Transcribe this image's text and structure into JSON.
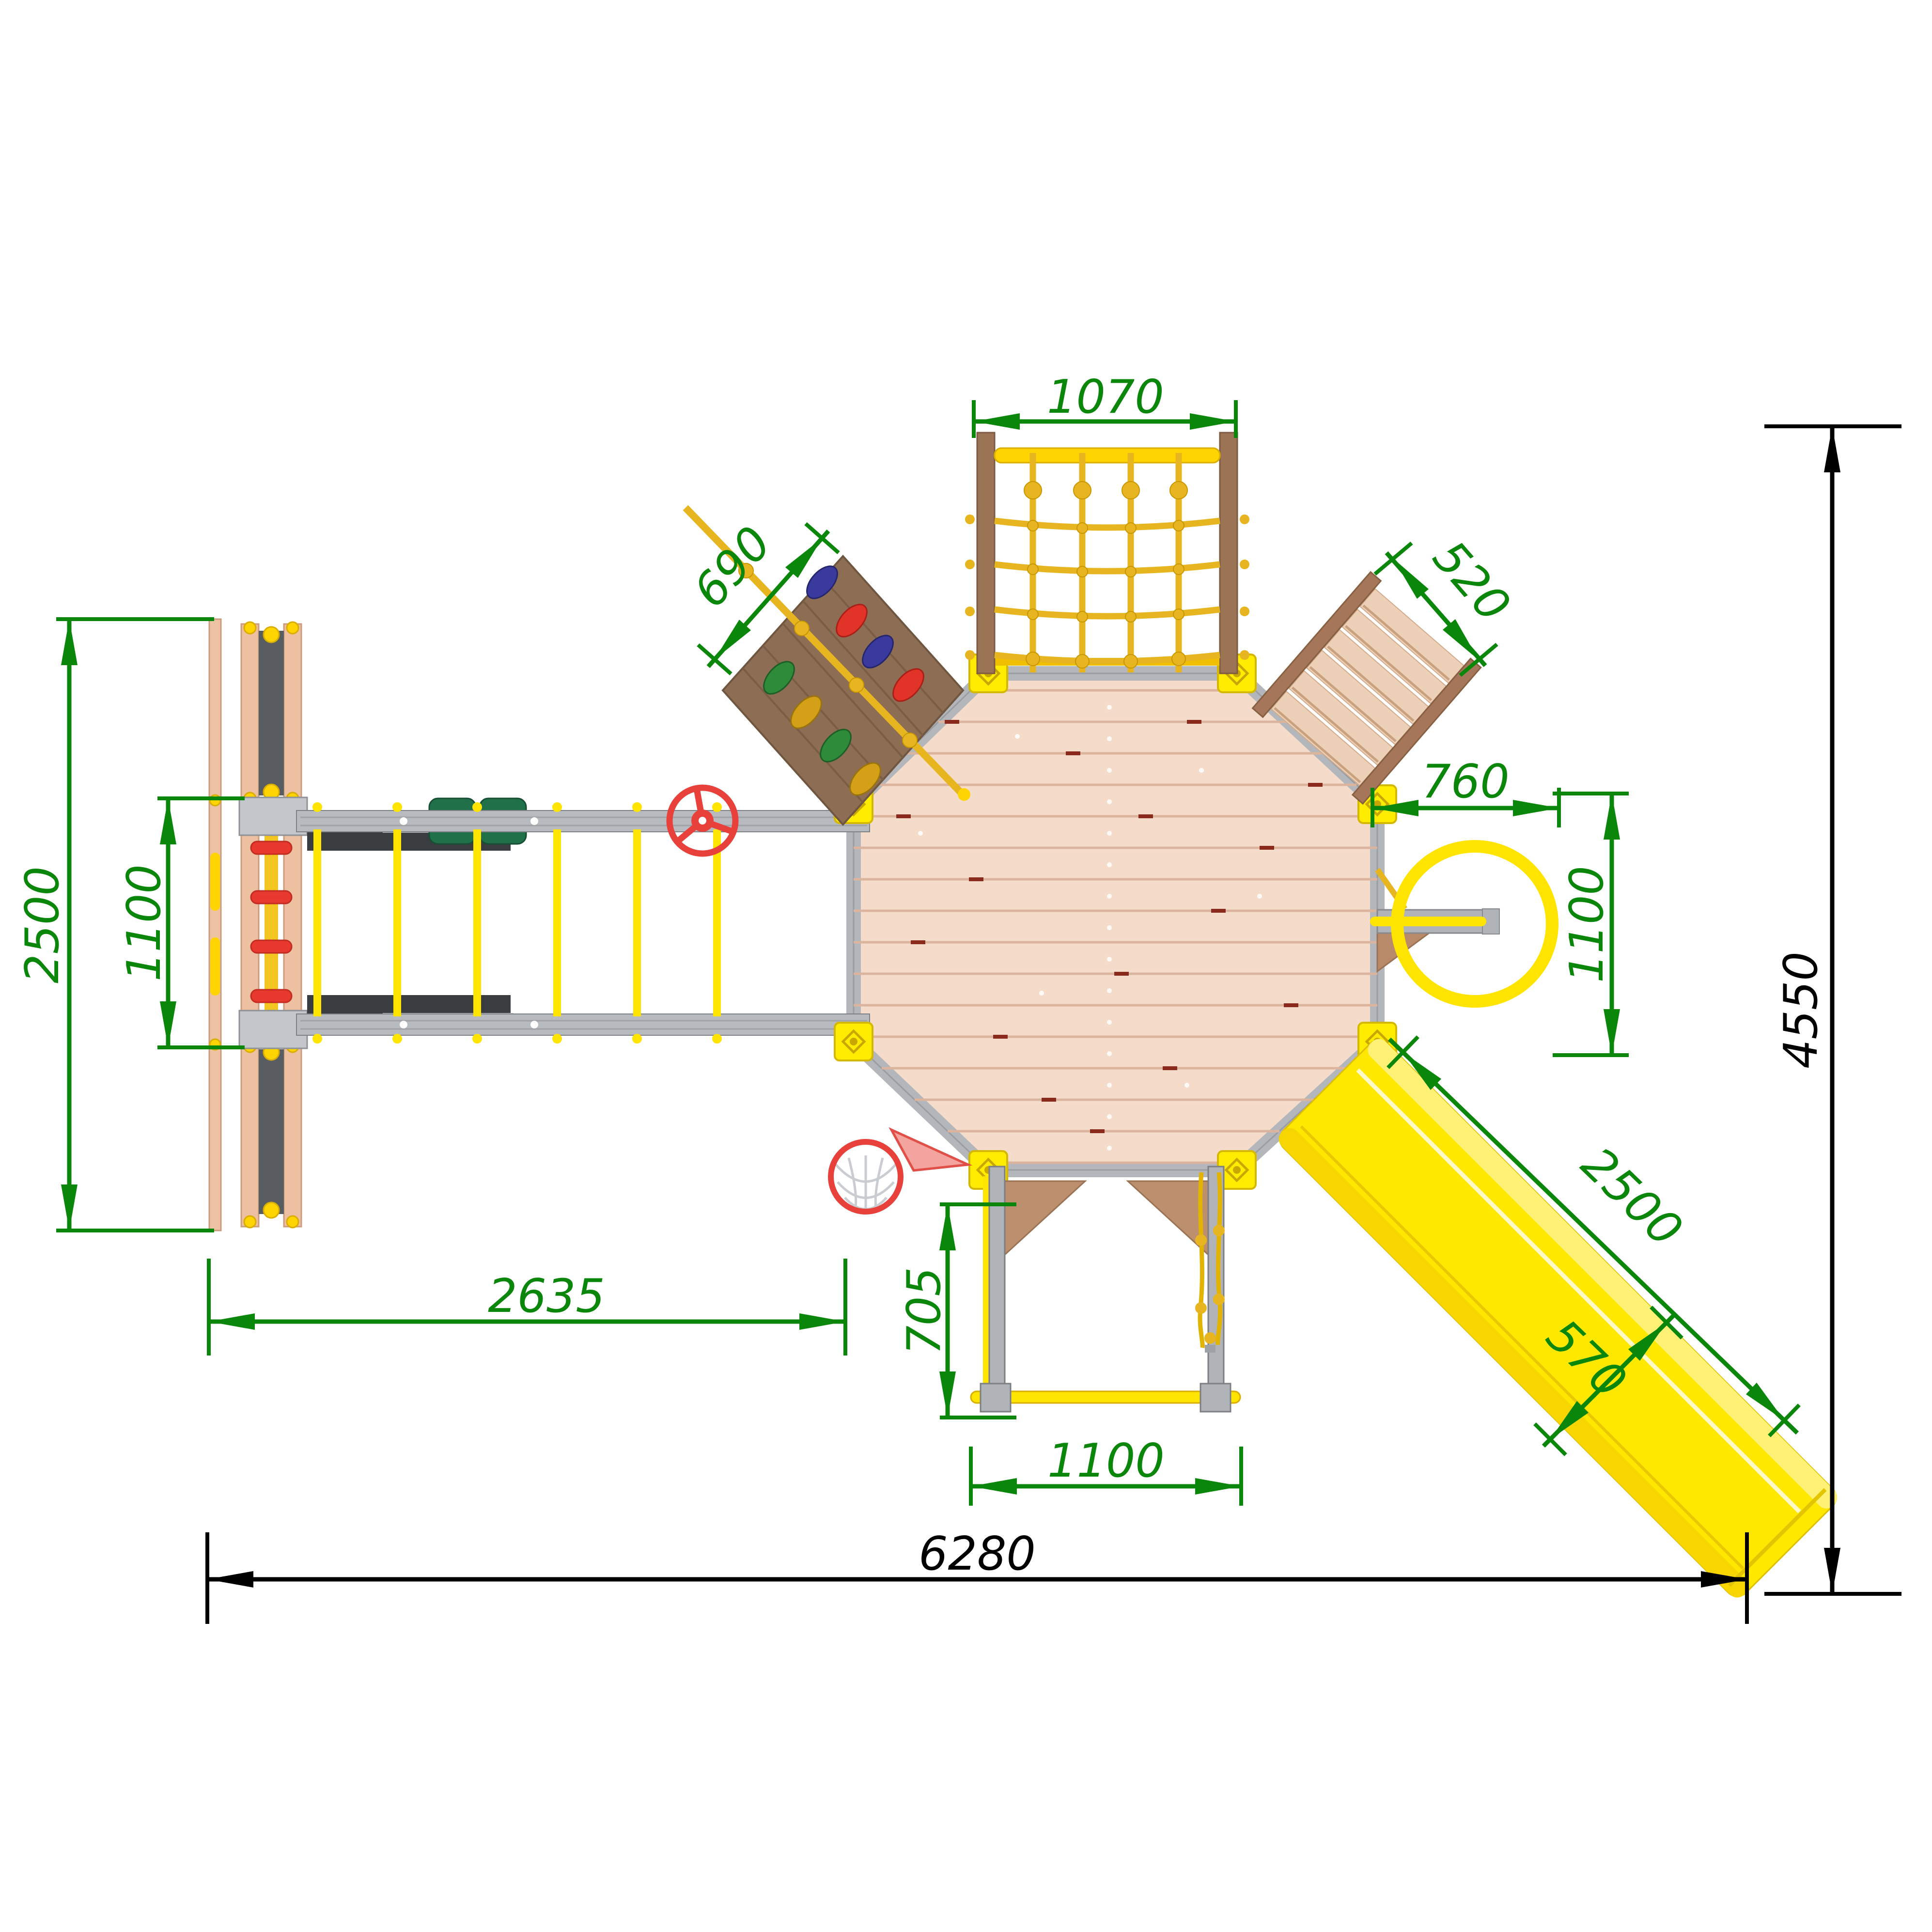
{
  "drawing": {
    "kind": "playground-set top view installation plan",
    "units": "mm",
    "background": "#ffffff"
  },
  "dims": {
    "net_width": "1070",
    "climb_wall_width": "690",
    "stairs_width": "520",
    "ring_offset": "760",
    "ring_clearance": "1100",
    "module_depth": "2500",
    "ladder_width": "1100",
    "bridge_length": "2635",
    "swing_depth": "705",
    "swing_width": "1100",
    "slide_length": "2500",
    "slide_width": "570",
    "overall_length": "6280",
    "overall_depth": "4550"
  },
  "components": {
    "platform": "octagonal-deck",
    "net": "climbing-net",
    "wall": "climbing-wall",
    "stairs": "access-stairs",
    "ring": "fireman-ring",
    "slide": "slide",
    "swing": "pull-up-bar-with-rope-ladder",
    "hoop": "basketball-hoop",
    "bridge": "monkey-bar-bridge",
    "ladder": "side-ladder-module",
    "wheel": "steering-wheel"
  },
  "colors": {
    "dimension_green": "#0a870a",
    "dimension_black": "#000000",
    "deck_wood": "#f5dcca",
    "frame_gray": "#b3b6ba",
    "part_yellow": "#ffe400",
    "rope_gold": "#e7b520",
    "wood_brown": "#8d6e54",
    "accent_red": "#e8413c"
  }
}
